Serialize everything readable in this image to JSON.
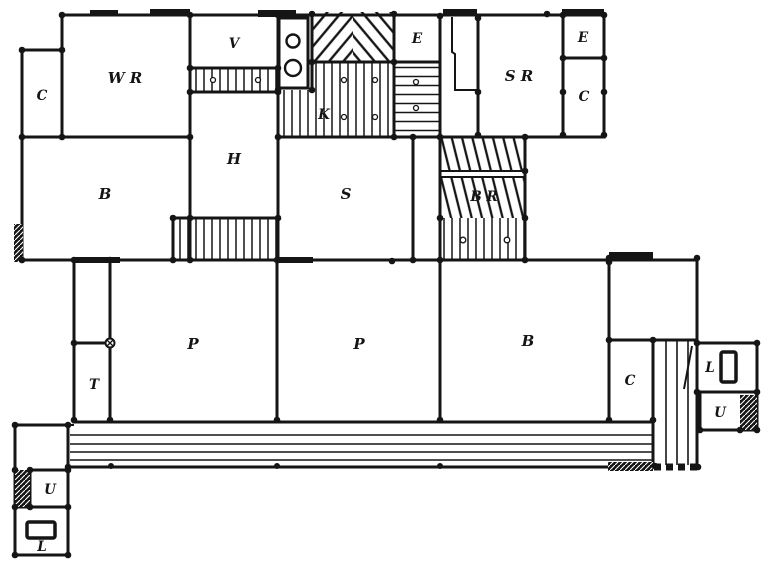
{
  "figure": {
    "ink_color": "#151515",
    "paper_color": "#ffffff"
  },
  "rooms": [
    {
      "id": "room-c-upper-left",
      "label": "C"
    },
    {
      "id": "room-wr",
      "label": "W R"
    },
    {
      "id": "room-v",
      "label": "V"
    },
    {
      "id": "room-k",
      "label": "K"
    },
    {
      "id": "room-e-upper-middle",
      "label": "E"
    },
    {
      "id": "room-sr",
      "label": "S R"
    },
    {
      "id": "room-e-upper-right",
      "label": "E"
    },
    {
      "id": "room-c-upper-right",
      "label": "C"
    },
    {
      "id": "room-b-upper-left",
      "label": "B"
    },
    {
      "id": "room-h",
      "label": "H"
    },
    {
      "id": "room-s",
      "label": "S"
    },
    {
      "id": "room-br",
      "label": "B R"
    },
    {
      "id": "room-p-left",
      "label": "P"
    },
    {
      "id": "room-p-center",
      "label": "P"
    },
    {
      "id": "room-b-lower-right",
      "label": "B"
    },
    {
      "id": "room-t",
      "label": "T"
    },
    {
      "id": "room-c-lower-right",
      "label": "C"
    },
    {
      "id": "room-l-right",
      "label": "L"
    },
    {
      "id": "room-u-right",
      "label": "U"
    },
    {
      "id": "room-u-left",
      "label": "U"
    },
    {
      "id": "room-l-left",
      "label": "L"
    }
  ]
}
